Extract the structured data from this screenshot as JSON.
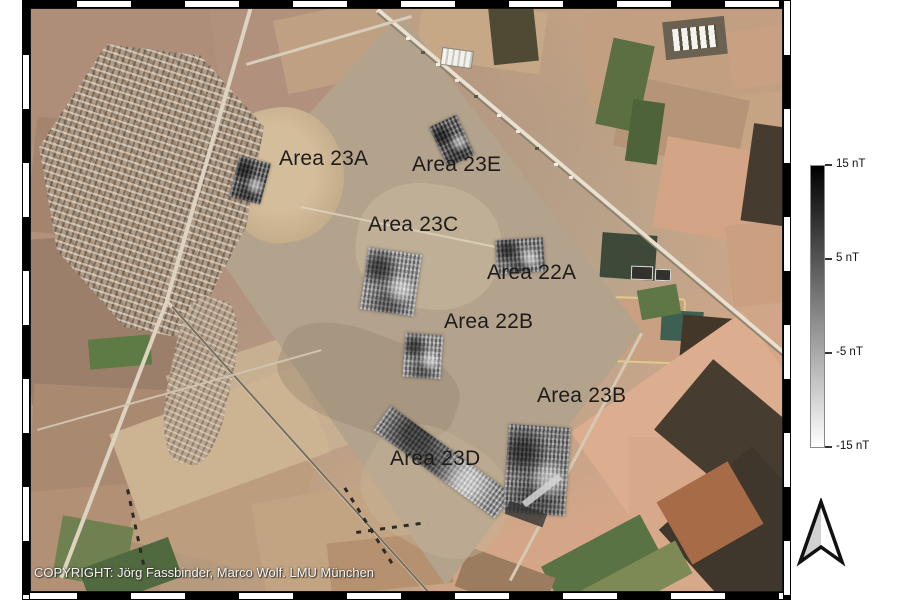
{
  "figure": {
    "copyright": "COPYRIGHT: Jörg Fassbinder, Marco Wolf. LMU München",
    "area_labels": [
      "Area 23A",
      "Area 23E",
      "Area 23C",
      "Area 22A",
      "Area 22B",
      "Area 23B",
      "Area 23D"
    ]
  },
  "colorbar": {
    "unit": "nT",
    "top_color": "#000000",
    "bottom_color": "#ffffff",
    "tick_labels": [
      "15 nT",
      "5 nT",
      "-5 nT",
      "-15 nT"
    ]
  }
}
